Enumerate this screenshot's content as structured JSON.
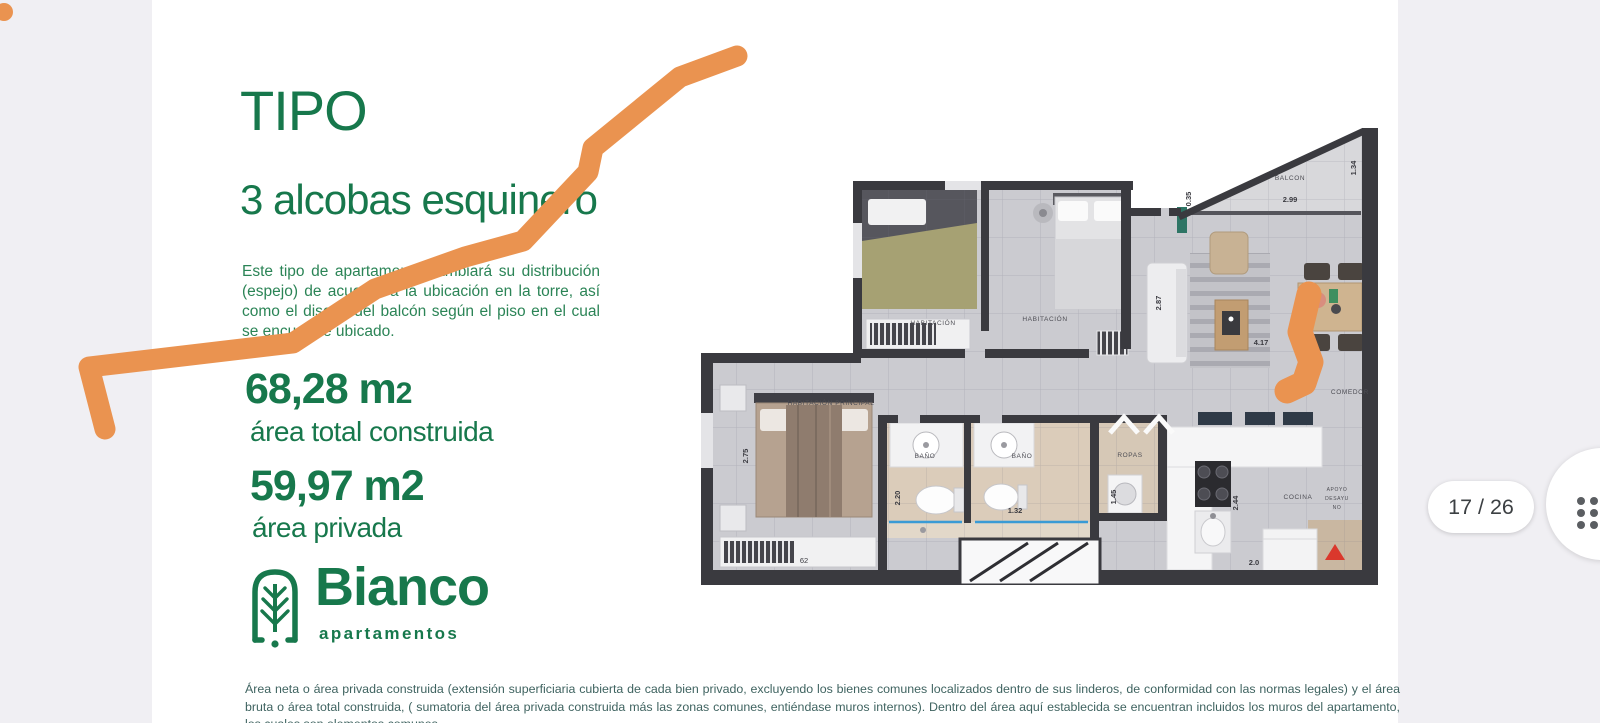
{
  "viewer": {
    "page_indicator": "17 / 26"
  },
  "slide": {
    "title": "TIPO",
    "subtitle": "3 alcobas esquinero",
    "description": "Este tipo de apartamento cambiará su distribución (espejo) de acuerdo a la ubicación en la torre, así como el diseño del balcón según el piso en el cual se encuentre ubicado.",
    "area_total_value": "68,28 m",
    "area_total_sup": "2",
    "area_total_label": "área total construida",
    "area_private_value": "59,97 m2",
    "area_private_label": "área  privada",
    "brand_name": "Bianco",
    "brand_tagline": "apartamentos",
    "disclaimer": "Área neta o área privada construida (extensión superficiaria cubierta de cada bien privado, excluyendo los bienes comunes localizados dentro de sus linderos, de conformidad con las normas legales) y el área bruta o área total construida, ( sumatoria del área privada construida más las zonas comunes, entiéndase muros internos). Dentro del área aquí establecida se encuentran incluidos los muros del apartamento, los cuales son elementos comunes."
  },
  "colors": {
    "brand_green": "#17784c",
    "marker_orange": "#ea9350",
    "disclaimer_teal": "#3f6360",
    "wall_dark": "#3a3a3f"
  },
  "floorplan": {
    "rooms": {
      "balcony": "BALCON",
      "bedroom1": "HABITACIÓN",
      "bedroom2": "HABITACIÓN",
      "master_bedroom": "HABITACIÓN PRINCIPAL",
      "bath1": "BAÑO",
      "bath2": "BAÑO",
      "laundry": "ROPAS",
      "kitchen": "COCINA",
      "dining": "COMEDOR"
    },
    "entry_note": [
      "APOYO",
      "DESAYU",
      "NO"
    ],
    "dims": {
      "balcony_width": "2.99",
      "balcony_right": "1.34",
      "balcony_left": "0.35",
      "living_width": "4.17",
      "living_height": "2.87",
      "master_height": "2.75",
      "bath_height": "2.20",
      "bath_width": "1.32",
      "laundry_height": "1.45",
      "laundry_width": "1.40",
      "kitchen_height": "2.44",
      "kitchen_width": "2.0",
      "closet_width": "62"
    }
  }
}
